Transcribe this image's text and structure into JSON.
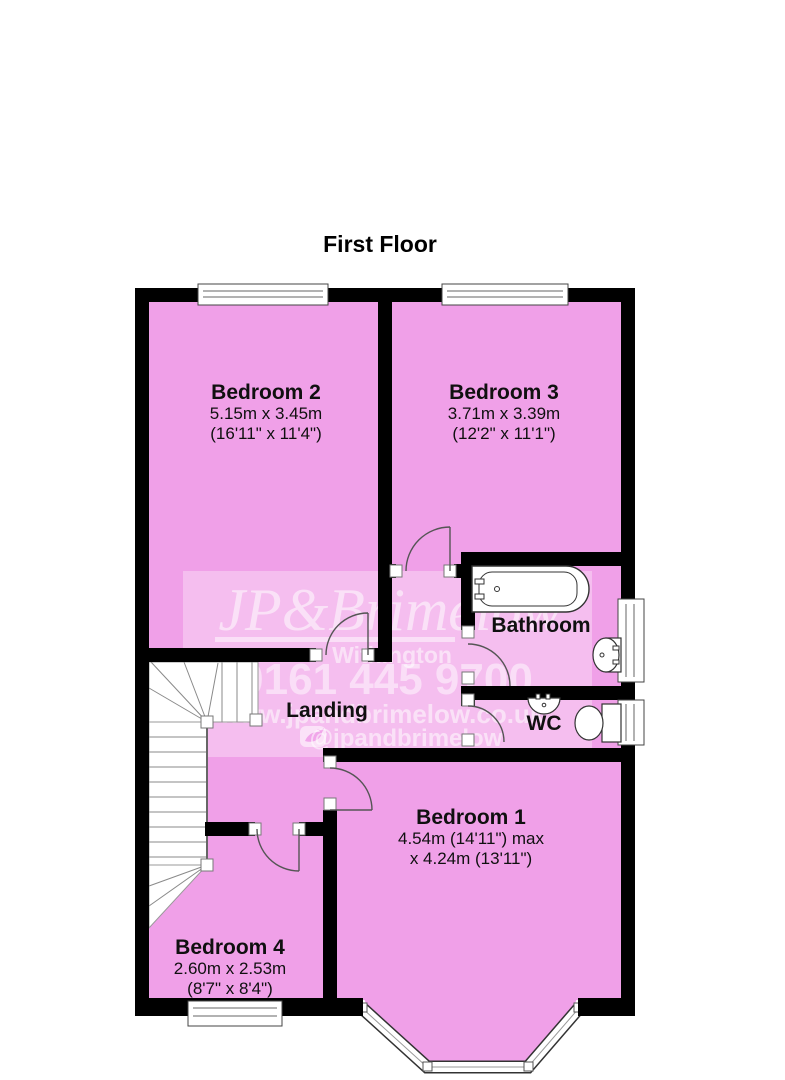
{
  "title": "First Floor",
  "rooms": {
    "bedroom2": {
      "name": "Bedroom 2",
      "line1": "5.15m x 3.45m",
      "line2": "(16'11\" x 11'4\")"
    },
    "bedroom3": {
      "name": "Bedroom 3",
      "line1": "3.71m x 3.39m",
      "line2": "(12'2\" x 11'1\")"
    },
    "bedroom1": {
      "name": "Bedroom 1",
      "line1": "4.54m (14'11\") max",
      "line2": "x 4.24m (13'11\")"
    },
    "bedroom4": {
      "name": "Bedroom 4",
      "line1": "2.60m x 2.53m",
      "line2": "(8'7\" x 8'4\")"
    },
    "bathroom": {
      "name": "Bathroom"
    },
    "wc": {
      "name": "WC"
    },
    "landing": {
      "name": "Landing"
    }
  },
  "watermark": {
    "brand": "JP&Brimelow",
    "location": "Withington",
    "phone": "0161 445 9700",
    "website": "www.jpandbrimelow.co.uk",
    "social_handle": "@jpandbrimelow",
    "icon": "twitter-icon"
  },
  "colors": {
    "room_fill": "#F0A0E8",
    "wall": "#000000",
    "watermark_text": "#FFFFFF",
    "background": "#FFFFFF"
  }
}
